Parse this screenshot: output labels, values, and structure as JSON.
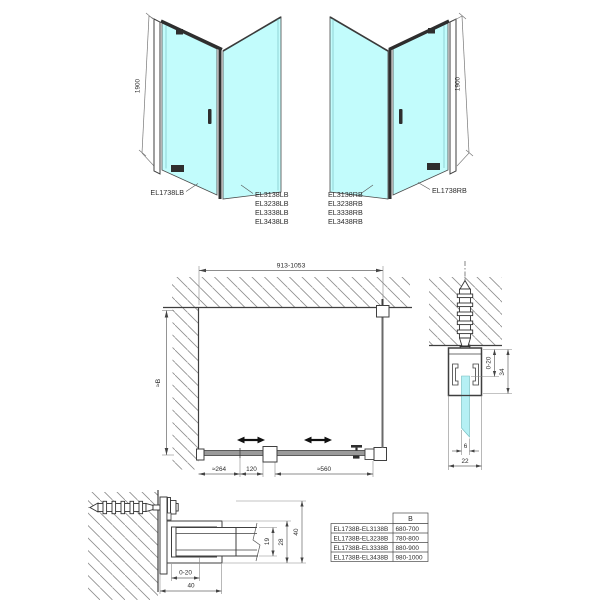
{
  "views": {
    "iso_left": {
      "height": "1900",
      "door": "EL1738LB",
      "panels": [
        "EL3138LB",
        "EL3238LB",
        "EL3338LB",
        "EL3438LB"
      ]
    },
    "iso_right": {
      "height": "1900",
      "door": "EL1738RB",
      "panels": [
        "EL3138RB",
        "EL3238RB",
        "EL3338RB",
        "EL3438RB"
      ]
    }
  },
  "plan": {
    "width": "913-1053",
    "depth": "≈B",
    "seg_fixed": "≈264",
    "seg_pivot": "120",
    "seg_door": "≈560"
  },
  "wall_profile": {
    "adjust": "0-20",
    "depth": "34",
    "glass": "6",
    "width": "22"
  },
  "door_profile": {
    "adjust": "0-20",
    "width": "40",
    "glass_depth": "19",
    "body": "28",
    "height": "40"
  },
  "table": {
    "col_b": "B",
    "rows": [
      {
        "model": "EL1738B-EL3138B",
        "b": "680-700"
      },
      {
        "model": "EL1738B-EL3238B",
        "b": "780-800"
      },
      {
        "model": "EL1738B-EL3338B",
        "b": "880-900"
      },
      {
        "model": "EL1738B-EL3438B",
        "b": "980-1000"
      }
    ]
  },
  "colors": {
    "glass": "#c2fcfc",
    "glass_section": "#b5f0f4",
    "line": "#3f3f3f"
  }
}
